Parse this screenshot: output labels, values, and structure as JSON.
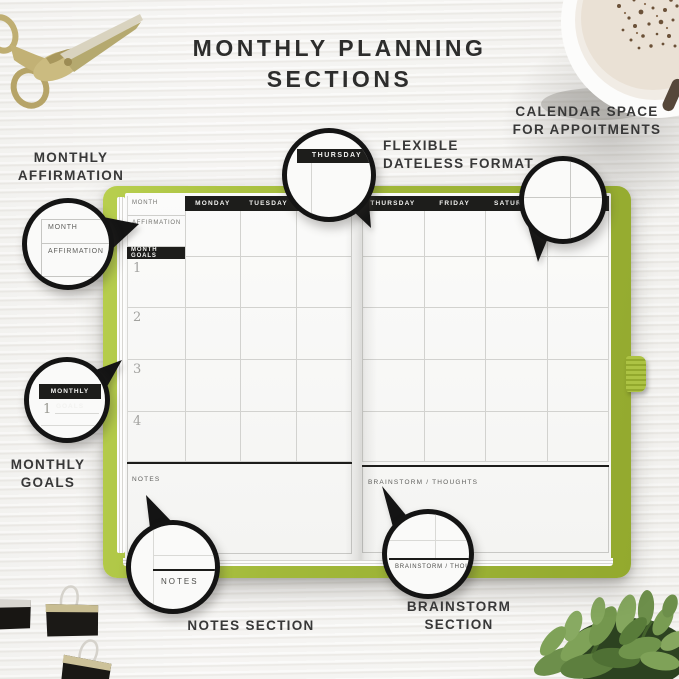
{
  "title": {
    "line1": "MONTHLY PLANNING",
    "line2": "SECTIONS"
  },
  "annotations": {
    "monthly_affirmation": {
      "line1": "MONTHLY",
      "line2": "AFFIRMATION"
    },
    "flexible_dateless_format": {
      "line1": "FLEXIBLE",
      "line2": "DATELESS FORMAT"
    },
    "calendar_space": {
      "line1": "CALENDAR SPACE",
      "line2": "FOR APPOITMENTS"
    },
    "monthly_goals": {
      "line1": "MONTHLY",
      "line2": "GOALS"
    },
    "notes_section": {
      "line1": "NOTES SECTION"
    },
    "brainstorm_section": {
      "line1": "BRAINSTORM",
      "line2": "SECTION"
    }
  },
  "planner": {
    "left_page": {
      "month_label": "MONTH",
      "affirmation_label": "AFFIRMATION",
      "goals_header": "MONTH GOALS",
      "goal_numbers": [
        "1",
        "2",
        "3",
        "4"
      ],
      "day_headers": [
        "MONDAY",
        "TUESDAY",
        "WEDNESDAY"
      ],
      "notes_label": "NOTES"
    },
    "right_page": {
      "day_headers": [
        "THURSDAY",
        "FRIDAY",
        "SATURDAY",
        "SUNDAY"
      ],
      "brainstorm_label": "BRAINSTORM / THOUGHTS"
    }
  },
  "callouts": {
    "affirmation": {
      "month": "MONTH",
      "affirmation": "AFFIRMATION"
    },
    "thursday": {
      "day": "THURSDAY"
    },
    "goals": {
      "badge": "MONTHLY GOALS",
      "number": "1"
    },
    "notes": {
      "label": "NOTES"
    },
    "brainstorm": {
      "label": "BRAINSTORM / THOUGH"
    }
  },
  "colors": {
    "cover_green": "#a4bb35",
    "header_black": "#1d1d1b",
    "label_text": "#383838",
    "grid_line": "#d2d2cf",
    "page_white": "#f8f8f6"
  },
  "props": {
    "top_left": "gold-stork-scissors",
    "top_right": "cappuccino-cup",
    "bottom_left": "binder-clips",
    "bottom_right": "green-plant"
  }
}
